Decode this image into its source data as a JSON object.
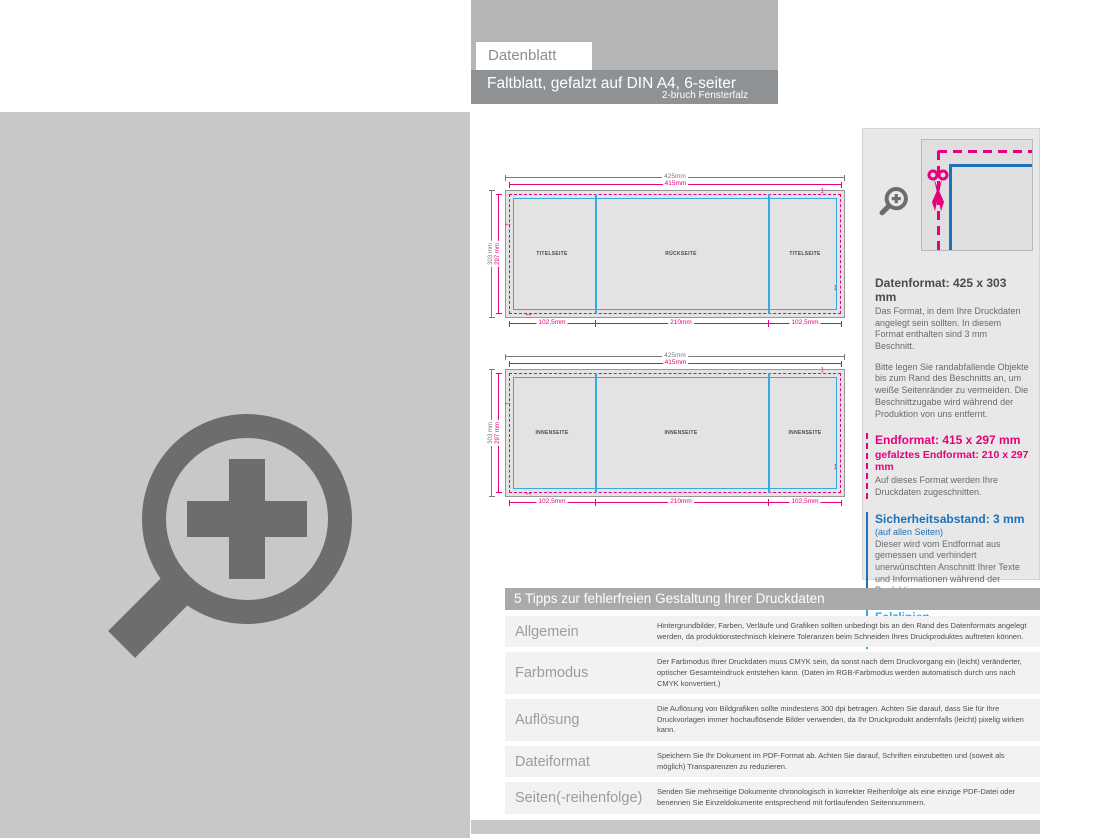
{
  "header": {
    "tab_label": "Datenblatt",
    "title": "Faltblatt, gefalzt auf DIN A4, 6-seiter",
    "subtitle": "2-bruch Fensterfalz"
  },
  "diagrams": {
    "outside": {
      "dim_width_data": "425mm",
      "dim_width_end": "415mm",
      "dim_height_data": "303 mm",
      "dim_height_end": "297 mm",
      "panel_left": "TITELSEITE",
      "panel_center": "RÜCKSEITE",
      "panel_right": "TITELSEITE",
      "dim_bottom_left": "102,5mm",
      "dim_bottom_center": "210mm",
      "dim_bottom_right": "102,5mm"
    },
    "inside": {
      "dim_width_data": "425mm",
      "dim_width_end": "415mm",
      "dim_height_data": "303 mm",
      "dim_height_end": "297 mm",
      "panel_left": "INNENSEITE",
      "panel_center": "INNENSEITE",
      "panel_right": "INNENSEITE",
      "dim_bottom_left": "102,5mm",
      "dim_bottom_center": "210mm",
      "dim_bottom_right": "102,5mm"
    }
  },
  "sidebar": {
    "datenformat": {
      "heading": "Datenformat: 425 x 303 mm",
      "body": "Das Format, in dem Ihre Druckdaten angelegt sein sollten. In diesem Format enthalten sind 3 mm Beschnitt.",
      "body2": "Bitte legen Sie randabfallende Objekte bis zum Rand des Beschnitts an, um weiße Seitenränder zu vermeiden. Die Beschnittzugabe wird während der Produktion von uns entfernt."
    },
    "endformat": {
      "heading": "Endformat: 415 x 297 mm",
      "subheading": "gefalztes Endformat: 210 x 297 mm",
      "body": "Auf dieses Format werden Ihre Druckdaten zugeschnitten."
    },
    "sicherheitsabstand": {
      "heading": "Sicherheitsabstand: 3 mm",
      "subheading": "(auf allen Seiten)",
      "body": "Dieser wird vom Endformat aus gemessen und verhindert unerwünschten Anschnitt Ihrer Texte und Informationen während der Produktion."
    },
    "falzlinien": {
      "heading": "Falzlinien",
      "body": "Hier befinden sich die Falzpositionen in Ihrem Produkt"
    }
  },
  "tips": {
    "title": "5 Tipps zur fehlerfreien Gestaltung Ihrer Druckdaten",
    "rows": [
      {
        "label": "Allgemein",
        "text": "Hintergrundbilder, Farben, Verläufe und Grafiken sollten unbedingt bis an den Rand des Datenformats angelegt werden, da produktionstechnisch kleinere Toleranzen beim Schneiden Ihres Druckproduktes auftreten können."
      },
      {
        "label": "Farbmodus",
        "text": "Der Farbmodus Ihrer Druckdaten muss CMYK sein, da sonst nach dem Druckvorgang ein (leicht) veränderter, optischer Gesamteindruck entstehen kann. (Daten im RGB-Farbmodus werden automatisch durch uns nach CMYK konvertiert.)"
      },
      {
        "label": "Auflösung",
        "text": "Die Auflösung von Bildgrafiken sollte mindestens 300 dpi betragen. Achten Sie darauf, dass Sie für Ihre Druckvorlagen immer hochauflösende Bilder verwenden, da Ihr Druckprodukt andernfalls (leicht) pixelig wirken kann."
      },
      {
        "label": "Dateiformat",
        "text": "Speichern Sie Ihr Dokument im PDF-Format ab. Achten Sie darauf, Schriften einzubetten und (soweit als möglich) Transparenzen zu reduzieren."
      },
      {
        "label": "Seiten(-reihenfolge)",
        "text": "Senden Sie mehrseitige Dokumente chronologisch in korrekter Reihenfolge als eine einzige PDF-Datei oder benennen Sie Einzeldokumente entsprechend mit fortlaufenden Seitennummern."
      }
    ]
  },
  "icons": {
    "zoom_large": "magnifier-plus",
    "zoom_small": "magnifier-plus",
    "scissors": "cut-mark"
  },
  "colors": {
    "magenta": "#e5007d",
    "fold_blue": "#36a9e1",
    "safety_blue": "#1d71b8",
    "placeholder_gray": "#c6c8c9"
  }
}
